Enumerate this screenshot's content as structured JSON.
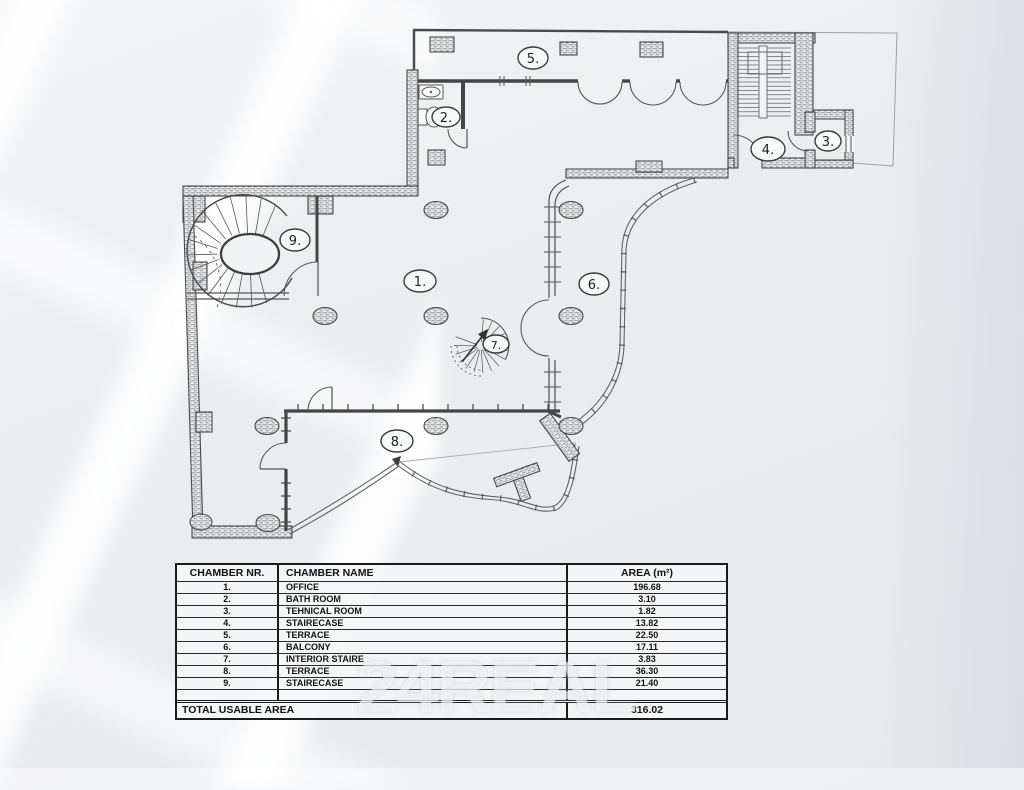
{
  "plan": {
    "labels": {
      "r1": "1.",
      "r2": "2.",
      "r3": "3.",
      "r4": "4.",
      "r5": "5.",
      "r6": "6.",
      "r7": "7.",
      "r8": "8.",
      "r9": "9."
    }
  },
  "table": {
    "headers": [
      "CHAMBER NR.",
      "CHAMBER NAME",
      "AREA (m²)"
    ],
    "rows": [
      [
        "1.",
        "OFFICE",
        "196.68"
      ],
      [
        "2.",
        "BATH ROOM",
        "3.10"
      ],
      [
        "3.",
        "TEHNICAL ROOM",
        "1.82"
      ],
      [
        "4.",
        "STAIRECASE",
        "13.82"
      ],
      [
        "5.",
        "TERRACE",
        "22.50"
      ],
      [
        "6.",
        "BALCONY",
        "17.11"
      ],
      [
        "7.",
        "INTERIOR STAIRE",
        "3.83"
      ],
      [
        "8.",
        "TERRACE",
        "36.30"
      ],
      [
        "9.",
        "STAIRECASE",
        "21.40"
      ]
    ],
    "total_label": "TOTAL USABLE  AREA",
    "total_value": "316.02"
  },
  "watermark": "24REAL",
  "colors": {
    "wall": "#4a4a4a",
    "hatch": "#8a8f94",
    "table_border": "#1b1b1b",
    "watermark": "#fdfeff"
  }
}
